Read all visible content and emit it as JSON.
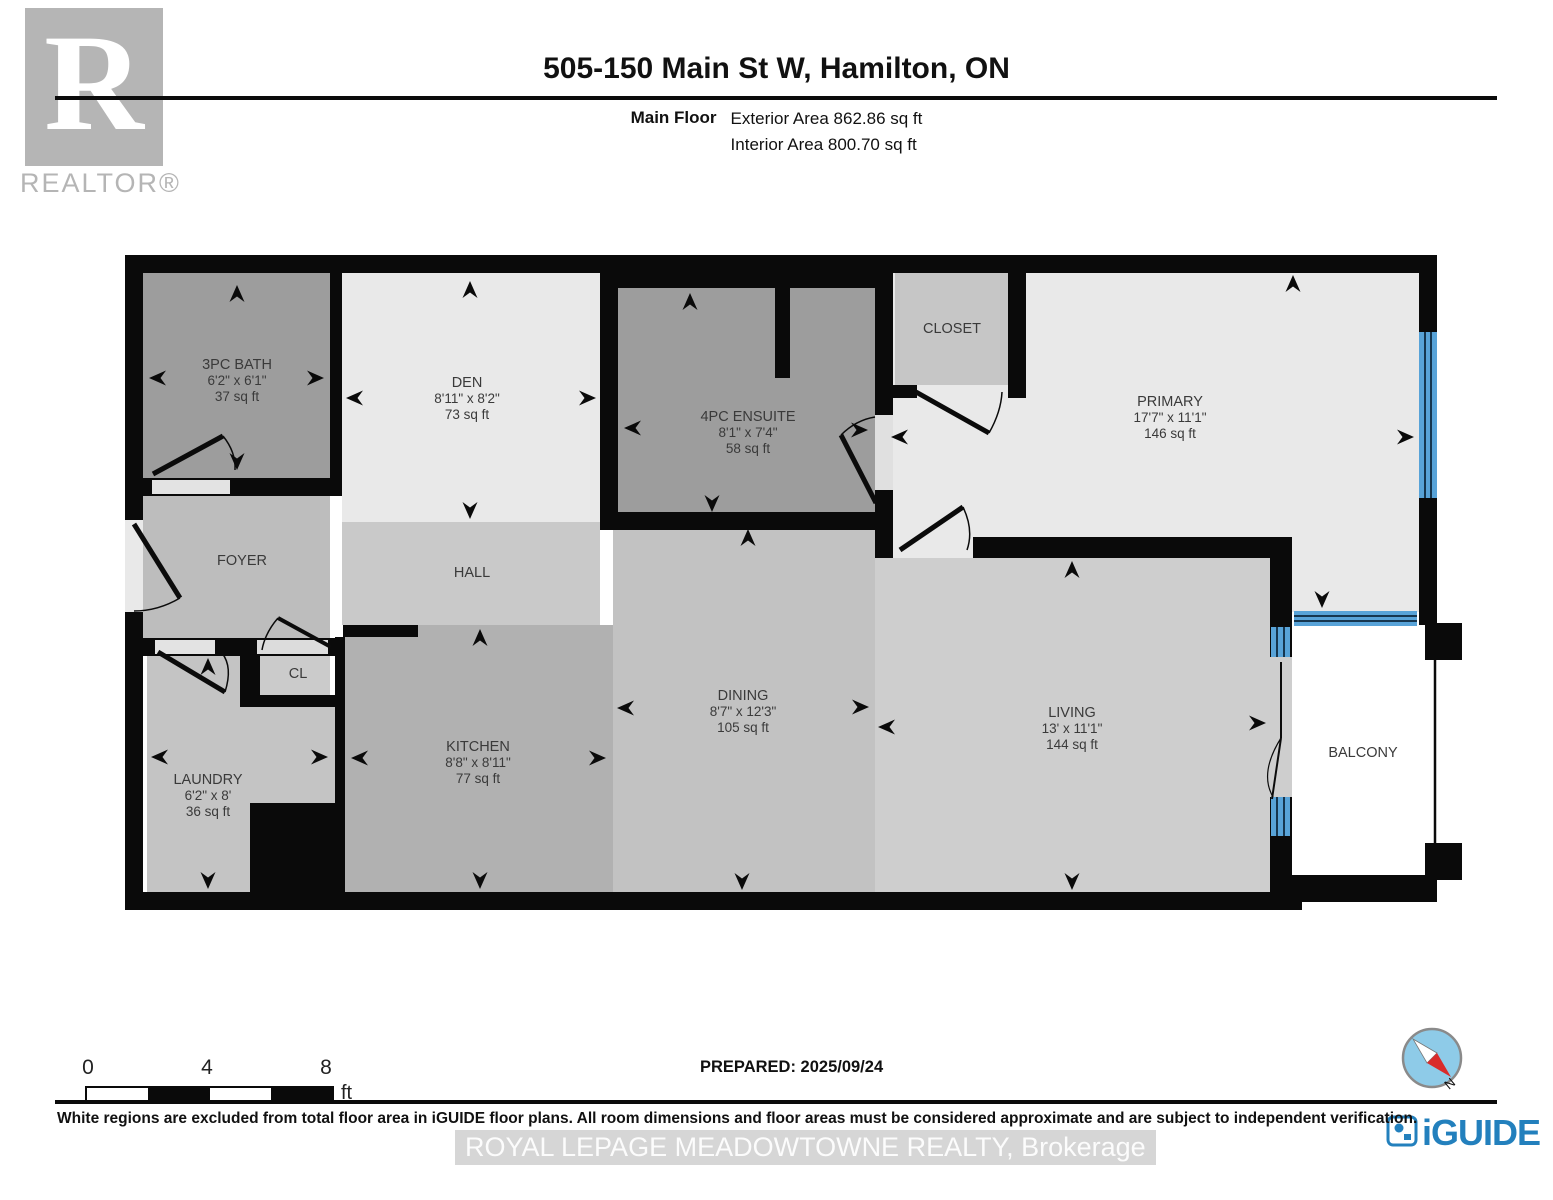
{
  "header": {
    "logo_letter": "R",
    "logo_word": "REALTOR®",
    "title": "505-150 Main St W, Hamilton, ON",
    "floor_label": "Main Floor",
    "exterior_area": "Exterior Area 862.86 sq ft",
    "interior_area": "Interior Area 800.70 sq ft"
  },
  "rooms": [
    {
      "name": "3PC BATH",
      "dims": "6'2\" x 6'1\"",
      "area": "37 sq ft"
    },
    {
      "name": "DEN",
      "dims": "8'11\" x 8'2\"",
      "area": "73 sq ft"
    },
    {
      "name": "4PC ENSUITE",
      "dims": "8'1\" x 7'4\"",
      "area": "58 sq ft"
    },
    {
      "name": "CLOSET",
      "dims": "",
      "area": ""
    },
    {
      "name": "PRIMARY",
      "dims": "17'7\" x 11'1\"",
      "area": "146 sq ft"
    },
    {
      "name": "FOYER",
      "dims": "",
      "area": ""
    },
    {
      "name": "HALL",
      "dims": "",
      "area": ""
    },
    {
      "name": "CL",
      "dims": "",
      "area": ""
    },
    {
      "name": "LAUNDRY",
      "dims": "6'2\" x 8'",
      "area": "36 sq ft"
    },
    {
      "name": "KITCHEN",
      "dims": "8'8\" x 8'11\"",
      "area": "77 sq ft"
    },
    {
      "name": "DINING",
      "dims": "8'7\" x 12'3\"",
      "area": "105 sq ft"
    },
    {
      "name": "LIVING",
      "dims": "13' x 11'1\"",
      "area": "144 sq ft"
    },
    {
      "name": "BALCONY",
      "dims": "",
      "area": ""
    }
  ],
  "footer": {
    "scale_0": "0",
    "scale_4": "4",
    "scale_8": "8",
    "scale_unit": "ft",
    "prepared": "PREPARED: 2025/09/24",
    "compass_label": "N",
    "disclaimer": "White regions are excluded from total floor area in iGUIDE floor plans. All room dimensions and floor areas must be considered approximate and are subject to independent verification.",
    "watermark": "ROYAL LEPAGE MEADOWTOWNE REALTY, Brokerage",
    "brand": "iGUIDE"
  },
  "colors": {
    "wall": "#0a0a0a",
    "window_blue": "#58a3d8",
    "brand_blue": "#2380bd",
    "compass_red": "#d92b2b"
  }
}
